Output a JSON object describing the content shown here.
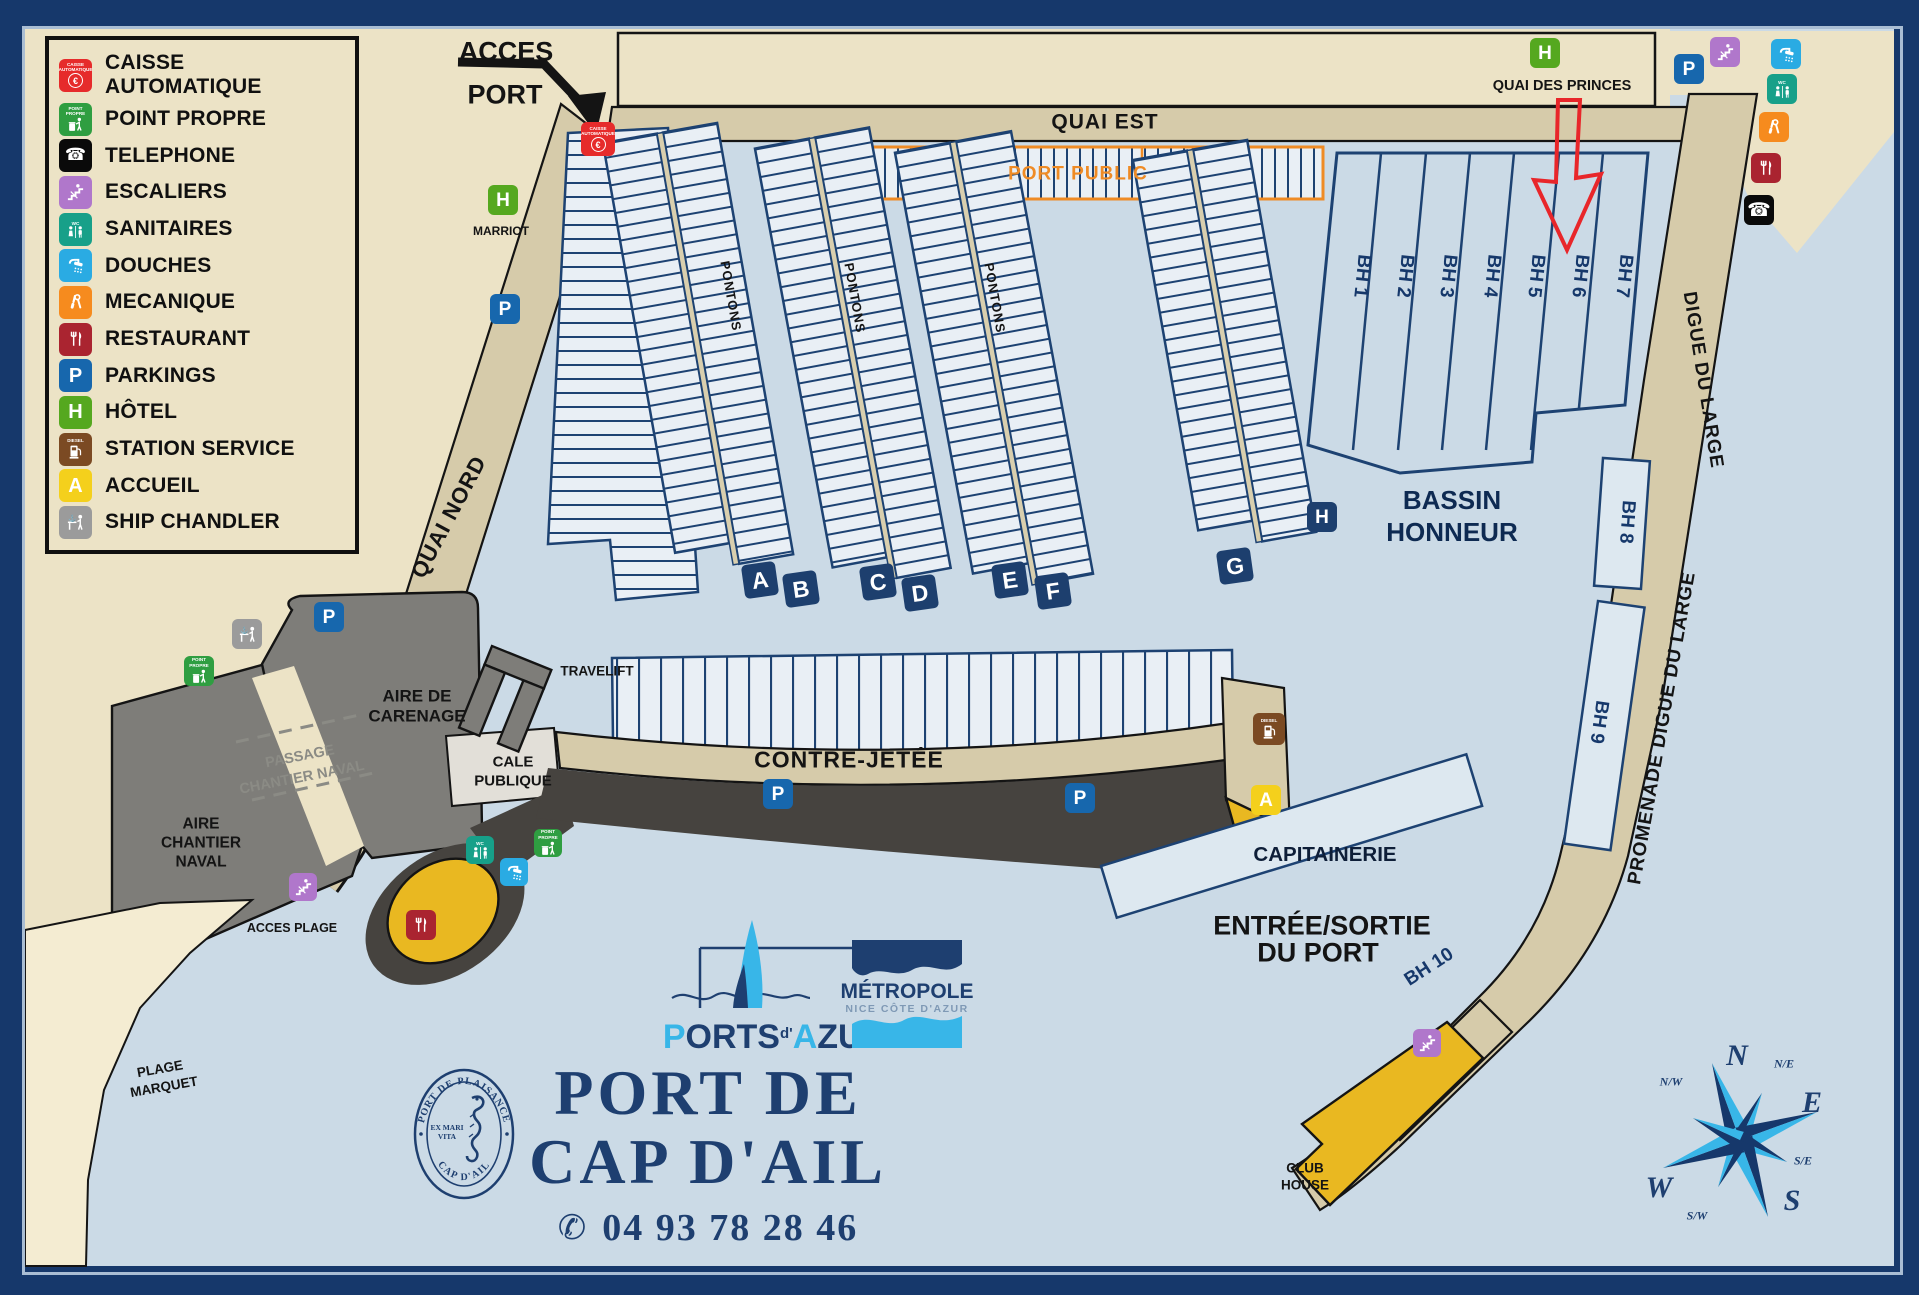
{
  "colors": {
    "navy": "#16386b",
    "berth_line": "#1d4272",
    "water": "#cbdae6",
    "land": "#ece3c6",
    "road": "#d6cbaa",
    "orange": "#ef8b25",
    "gray": "#7e7d79",
    "riprap": "#46433f",
    "sand": "#f4ecd2",
    "yellow": "#e9b821",
    "red": "#e8262a",
    "cyan": "#38b6e8",
    "slip_fill": "#e9eff5"
  },
  "legend": {
    "items": [
      {
        "id": "caisse",
        "label": "CAISSE AUTOMATIQUE",
        "color": "#e62b2b"
      },
      {
        "id": "pointpropre",
        "label": "POINT PROPRE",
        "color": "#2f9e41"
      },
      {
        "id": "telephone",
        "label": "TELEPHONE",
        "color": "#0a0a0a"
      },
      {
        "id": "escaliers",
        "label": "ESCALIERS",
        "color": "#b077cb"
      },
      {
        "id": "sanitaires",
        "label": "SANITAIRES",
        "color": "#17a089"
      },
      {
        "id": "douches",
        "label": "DOUCHES",
        "color": "#2aabe3"
      },
      {
        "id": "mecanique",
        "label": "MECANIQUE",
        "color": "#f68b1e"
      },
      {
        "id": "restaurant",
        "label": "RESTAURANT",
        "color": "#aa2430"
      },
      {
        "id": "parking",
        "label": "PARKINGS",
        "color": "#1767ad"
      },
      {
        "id": "hotel",
        "label": "HÔTEL",
        "color": "#55a81f"
      },
      {
        "id": "station",
        "label": "STATION SERVICE",
        "color": "#7b4a23"
      },
      {
        "id": "accueil",
        "label": "ACCUEIL",
        "color": "#f4d01c"
      },
      {
        "id": "shipchandler",
        "label": "SHIP CHANDLER",
        "color": "#9b9b9b"
      }
    ]
  },
  "icon_captions": {
    "caisse": "CAISSE AUTOMATIQUE",
    "pointpropre": "POINT PROPRE",
    "sanitaires": "WC",
    "station": "DIESEL"
  },
  "map_labels": {
    "acces_1": "ACCES",
    "acces_2": "PORT",
    "quai_est": "QUAI EST",
    "quai_des_princes": "QUAI DES PRINCES",
    "marriot": "MARRIOT",
    "port_public": "PORT PUBLIC",
    "quai_nord": "QUAI NORD",
    "pontons": "PONTONS",
    "bassin_1": "BASSIN",
    "bassin_2": "HONNEUR",
    "digue": "DIGUE DU LARGE",
    "promenade": "PROMENADE DIGUE DU LARGE",
    "travelift": "TRAVELIFT",
    "carenage_1": "AIRE DE",
    "carenage_2": "CARENAGE",
    "cale_1": "CALE",
    "cale_2": "PUBLIQUE",
    "passage_1": "PASSAGE",
    "passage_2": "CHANTIER NAVAL",
    "chantier_1": "AIRE",
    "chantier_2": "CHANTIER",
    "chantier_3": "NAVAL",
    "acces_plage": "ACCES PLAGE",
    "plage_1": "PLAGE",
    "plage_2": "MARQUET",
    "contre_jetee": "CONTRE-JETÉE",
    "capitainerie": "CAPITAINERIE",
    "entree_1": "ENTRÉE/SORTIE",
    "entree_2": "DU PORT",
    "club_1": "CLUB",
    "club_2": "HOUSE"
  },
  "berths": {
    "pontoon_letters": [
      "A",
      "B",
      "C",
      "D",
      "E",
      "F",
      "G"
    ],
    "bh": [
      "BH 1",
      "BH 2",
      "BH 3",
      "BH 4",
      "BH 5",
      "BH 6",
      "BH 7"
    ],
    "bh8": "BH 8",
    "bh9": "BH 9",
    "bh10": "BH 10"
  },
  "seal": {
    "arc_top": "PORT DE PLAISANCE",
    "arc_bottom": "CAP D'AIL",
    "center_1": "EX MARI",
    "center_2": "VITA"
  },
  "logos": {
    "pa_p": "P",
    "pa_orts": "ORTS",
    "pa_d": "d'",
    "pa_a": "A",
    "pa_zur": "ZUR",
    "metropole_1": "MÉTROPOLE",
    "metropole_2": "NICE CÔTE D'AZUR"
  },
  "footer": {
    "title_1": "PORT DE",
    "title_2": "CAP D'AIL",
    "phone": "04 93 78 28 46",
    "phone_icon": "✆"
  },
  "compass": {
    "n": "N",
    "e": "E",
    "s": "S",
    "w": "W",
    "ne": "N/E",
    "se": "S/E",
    "sw": "S/W",
    "nw": "N/W"
  }
}
